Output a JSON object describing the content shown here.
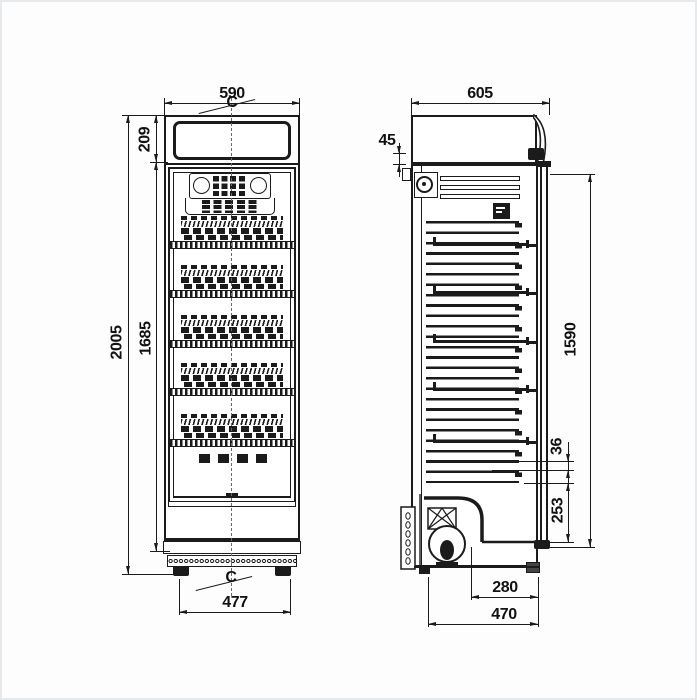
{
  "title": "Refrigerated display cabinet dimensional drawing",
  "colors": {
    "line": "#1b1b1b",
    "background": "#fdfdfd",
    "page_border": "#e7eaec"
  },
  "front_view": {
    "centerline_top": "C",
    "centerline_bottom": "C",
    "dim_width": "590",
    "dim_header_height": "209",
    "dim_total_height": "2005",
    "dim_interior_height": "1685",
    "dim_feet_spacing": "477"
  },
  "side_view": {
    "dim_depth": "605",
    "dim_top_gap": "45",
    "dim_door_height": "1590",
    "dim_shelf_gap": "36",
    "dim_lower_section": "253",
    "dim_machine_depth": "280",
    "dim_base_depth": "470"
  }
}
